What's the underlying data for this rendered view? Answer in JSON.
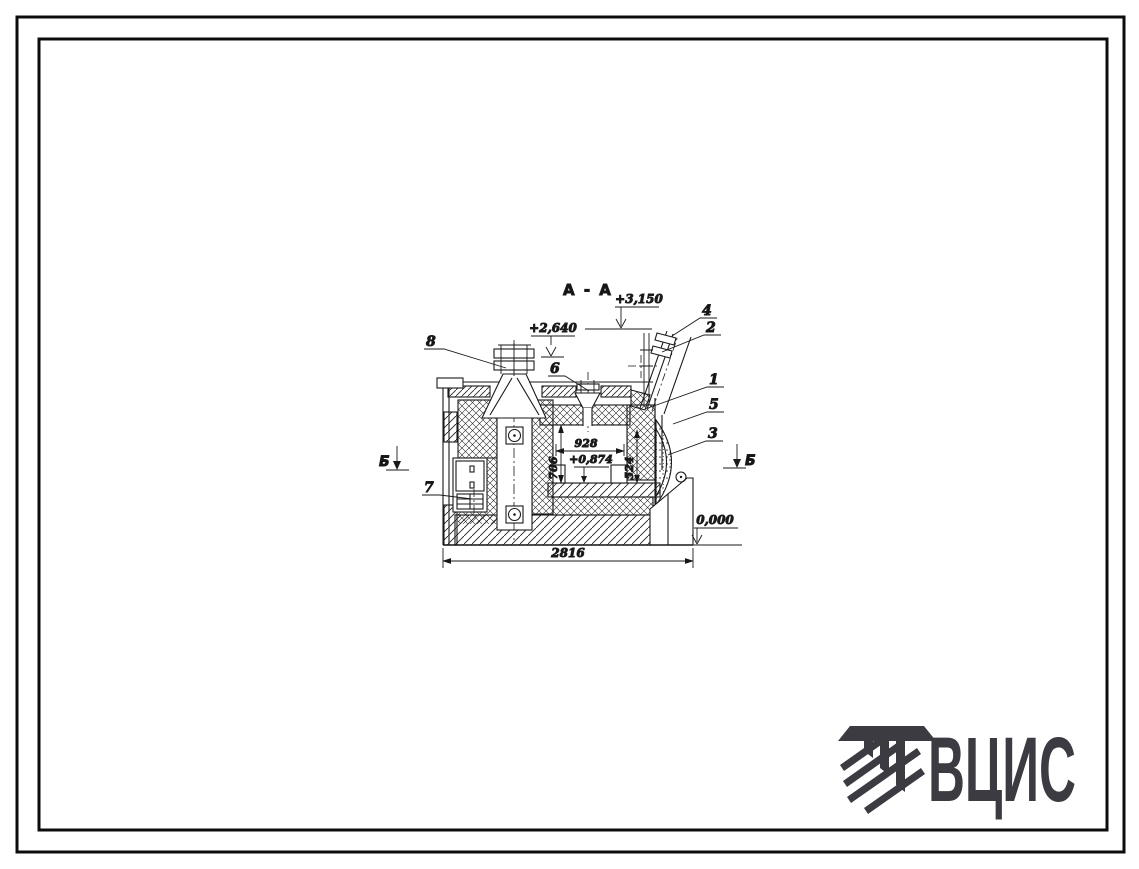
{
  "page": {
    "background": "#ffffff",
    "line_color": "#1a1a1a",
    "frame_color": "#0c0c0c"
  },
  "drawing": {
    "title": "А - А",
    "elevations": {
      "duct_top": "+3,150",
      "left_chimney": "+2,640",
      "hearth": "+0,874",
      "ground": "0,000"
    },
    "dimensions": {
      "overall_width": "2816",
      "chamber_width": "928",
      "chamber_height": "706",
      "right_wall_height": "524"
    },
    "callouts": [
      "1",
      "2",
      "3",
      "4",
      "5",
      "6",
      "7",
      "8"
    ],
    "section_markers": {
      "left": "Б",
      "right": "Б"
    }
  },
  "logo": {
    "text": "ВЦИС",
    "color": "#3b3b41"
  }
}
